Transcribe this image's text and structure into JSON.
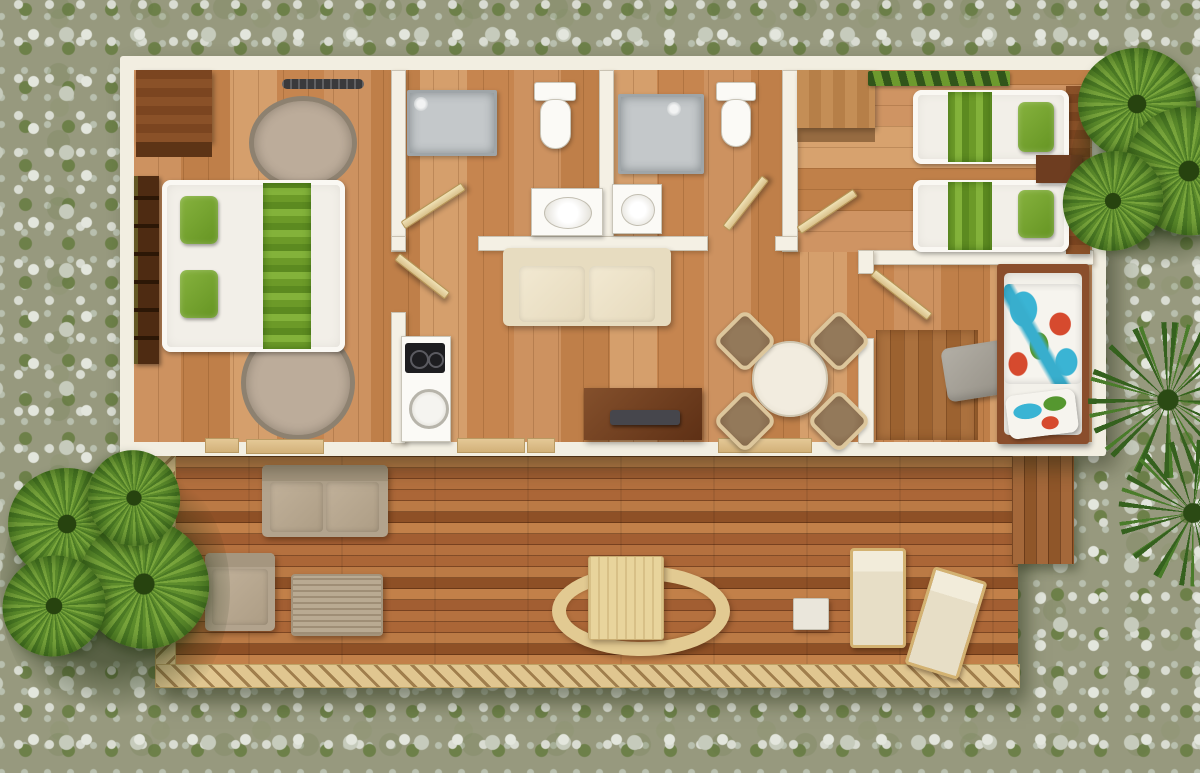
{
  "scene": {
    "type": "3d-floor-plan-top-view",
    "environment": "gravel ground with moss patches and fan palms",
    "palette": {
      "gravel": "#97997e",
      "moss": "#6d8049",
      "wall": "#f2eee1",
      "floor_oak": "#cd9260",
      "deck_wood": "#b5713f",
      "rail_tan": "#e0c690",
      "accent_green": "#76a32e",
      "dark_walnut": "#7b4520",
      "cream": "#efe6cf",
      "taupe_outdoor": "#b2a38d",
      "tropical_blue": "#3ab4d4",
      "tropical_red": "#d64a2e"
    },
    "rooms": {
      "master_bedroom": {
        "label": "master-bedroom",
        "items": [
          "wardrobe",
          "bookshelf",
          "round-rug",
          "round-rug-2",
          "double-bed",
          "green-runner",
          "green-pillows",
          "ceiling-vent"
        ]
      },
      "bathroom_1": {
        "label": "bathroom-1",
        "items": [
          "shower",
          "toilet",
          "sink",
          "door"
        ]
      },
      "bathroom_2": {
        "label": "bathroom-2",
        "items": [
          "shower",
          "toilet",
          "sink",
          "door"
        ]
      },
      "living_kitchen": {
        "label": "living-kitchen",
        "items": [
          "sofa",
          "kitchen-unit",
          "cooktop",
          "kitchen-sink",
          "tv-stand",
          "tv",
          "round-dining-table",
          "rattan-chair-1",
          "rattan-chair-2",
          "rattan-chair-3",
          "rattan-chair-4"
        ]
      },
      "twin_bedroom": {
        "label": "twin-bedroom",
        "items": [
          "green-runner-rug",
          "wardrobe",
          "single-bed-a",
          "single-bed-b",
          "nightstand",
          "headboards"
        ]
      },
      "kids_bedroom": {
        "label": "kids-bedroom",
        "items": [
          "single-bed",
          "tropical-blanket",
          "tropical-pillow",
          "grey-towel",
          "closet-floor",
          "door"
        ]
      }
    },
    "deck": {
      "label": "terrace-deck",
      "items": [
        "outdoor-sofa",
        "outdoor-armchair",
        "coffee-table",
        "deck-dining-table",
        "oval-bench",
        "sun-lounger-1",
        "sun-lounger-2",
        "side-table",
        "left-railing",
        "bottom-railing",
        "side-step"
      ]
    },
    "vegetation": {
      "items": [
        "fan-palm-left",
        "fan-palm-top-right",
        "spiky-palm-right"
      ]
    },
    "counts": {
      "bedrooms": 3,
      "bathrooms": 2,
      "beds": 4,
      "sun_loungers": 2,
      "dining_chairs": 4
    }
  }
}
